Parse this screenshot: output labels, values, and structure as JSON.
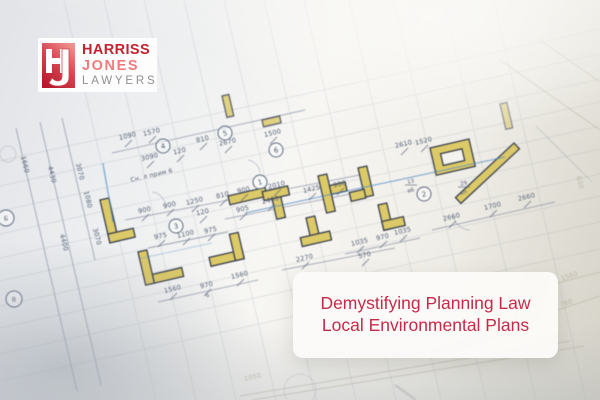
{
  "logo": {
    "monogram_letters": [
      "H",
      "J"
    ],
    "name_top": "HARRISS",
    "name_mid": "JONES",
    "name_bottom": "LAWYERS"
  },
  "banner": {
    "line1": "Demystifying Planning Law",
    "line2": "Local Environmental Plans"
  },
  "colors": {
    "logo_red": "#c0242f",
    "logo_pink": "#ef7b7d",
    "logo_gray": "#8e9092",
    "monogram_gradient_top": "#ee8f8c",
    "monogram_gradient_mid": "#d84653",
    "monogram_gradient_bottom": "#b5192b",
    "banner_text": "#c62a4a",
    "banner_bg": "#faf9f7",
    "wall_yellow": "#dcc967",
    "wall_edge": "#39404e",
    "plan_line": "#8a96a8",
    "accent_blue": "#4b87c7",
    "dim_text": "#525e74"
  },
  "blueprint": {
    "note": {
      "t": "Сн. л прим 6",
      "x": 152,
      "y": 177,
      "r": -13
    },
    "rooms": [
      {
        "n": "4",
        "x": 163,
        "y": 146
      },
      {
        "n": "5",
        "x": 225,
        "y": 133
      },
      {
        "n": "6",
        "x": 276,
        "y": 150
      },
      {
        "n": "1",
        "x": 260,
        "y": 182
      },
      {
        "n": "3",
        "x": 176,
        "y": 226
      },
      {
        "n": "2",
        "x": 424,
        "y": 194
      }
    ],
    "axes": [
      {
        "n": "Б",
        "x": 6,
        "y": 218
      },
      {
        "n": "В",
        "x": 14,
        "y": 299
      }
    ],
    "tags": [
      {
        "top": "13",
        "bottom": "в6",
        "x": 411,
        "y": 183
      },
      {
        "top": "29",
        "bottom": "вп",
        "x": 464,
        "y": 185
      },
      {
        "top": "6",
        "bottom": "",
        "x": 208,
        "y": 297
      }
    ],
    "dims": [
      {
        "t": "1090",
        "x": 128,
        "y": 138
      },
      {
        "t": "1570",
        "x": 152,
        "y": 134
      },
      {
        "t": "120",
        "x": 180,
        "y": 153
      },
      {
        "t": "3090",
        "x": 150,
        "y": 159
      },
      {
        "t": "810",
        "x": 203,
        "y": 141
      },
      {
        "t": "2670",
        "x": 228,
        "y": 144
      },
      {
        "t": "1500",
        "x": 273,
        "y": 135
      },
      {
        "t": "2610",
        "x": 404,
        "y": 146
      },
      {
        "t": "1520",
        "x": 424,
        "y": 143
      },
      {
        "t": "900",
        "x": 145,
        "y": 212
      },
      {
        "t": "900",
        "x": 170,
        "y": 207
      },
      {
        "t": "1250",
        "x": 195,
        "y": 203
      },
      {
        "t": "120",
        "x": 203,
        "y": 214
      },
      {
        "t": "810",
        "x": 223,
        "y": 197
      },
      {
        "t": "900",
        "x": 244,
        "y": 192
      },
      {
        "t": "2010",
        "x": 277,
        "y": 187
      },
      {
        "t": "1425",
        "x": 312,
        "y": 191
      },
      {
        "t": "900",
        "x": 340,
        "y": 186
      },
      {
        "t": "2400",
        "x": 271,
        "y": 202
      },
      {
        "t": "905",
        "x": 243,
        "y": 211
      },
      {
        "t": "975",
        "x": 161,
        "y": 238
      },
      {
        "t": "1100",
        "x": 186,
        "y": 236
      },
      {
        "t": "975",
        "x": 211,
        "y": 232
      },
      {
        "t": "2270",
        "x": 305,
        "y": 260
      },
      {
        "t": "570",
        "x": 365,
        "y": 257
      },
      {
        "t": "1035",
        "x": 360,
        "y": 244
      },
      {
        "t": "970",
        "x": 383,
        "y": 239
      },
      {
        "t": "1035",
        "x": 403,
        "y": 233
      },
      {
        "t": "2660",
        "x": 452,
        "y": 219
      },
      {
        "t": "1700",
        "x": 493,
        "y": 208
      },
      {
        "t": "2660",
        "x": 527,
        "y": 199
      },
      {
        "t": "1560",
        "x": 173,
        "y": 291
      },
      {
        "t": "970",
        "x": 207,
        "y": 287
      },
      {
        "t": "1560",
        "x": 240,
        "y": 277
      },
      {
        "t": "1660",
        "x": 23,
        "y": 165,
        "r": 76
      },
      {
        "t": "4430",
        "x": 50,
        "y": 175,
        "r": 76
      },
      {
        "t": "3070",
        "x": 78,
        "y": 172,
        "r": 76
      },
      {
        "t": "1080",
        "x": 86,
        "y": 200,
        "r": 76
      },
      {
        "t": "4400",
        "x": 62,
        "y": 243,
        "r": 76
      },
      {
        "t": "3070",
        "x": 95,
        "y": 237,
        "r": 76
      },
      {
        "t": "600",
        "x": 578,
        "y": 183,
        "r": 76,
        "f": 1
      },
      {
        "t": "1560",
        "x": 570,
        "y": 278,
        "r": -18,
        "f": 1
      },
      {
        "t": "760",
        "x": 567,
        "y": 305,
        "r": -18,
        "f": 1
      },
      {
        "t": "1050",
        "x": 253,
        "y": 379,
        "r": -12,
        "f": 1
      }
    ]
  }
}
